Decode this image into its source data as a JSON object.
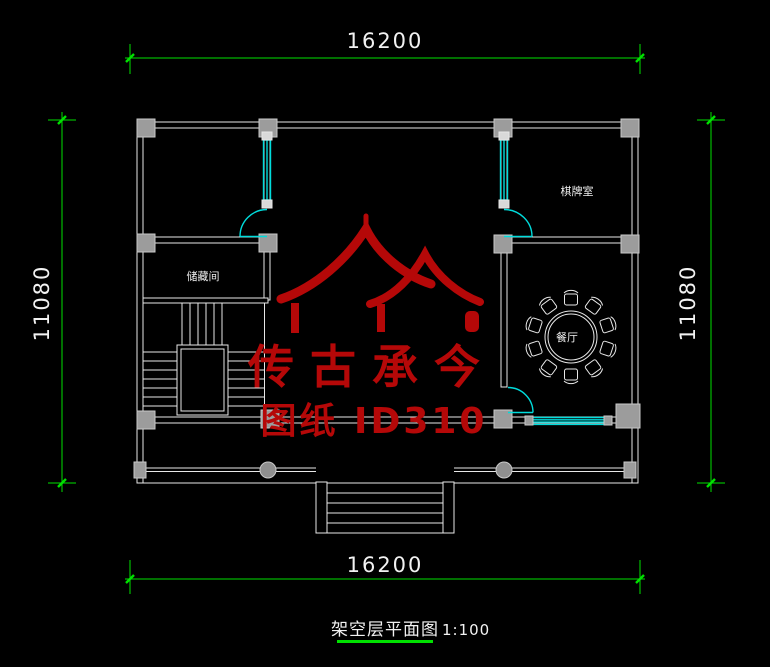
{
  "plan": {
    "dim_top": "16200",
    "dim_bottom": "16200",
    "dim_left": "11080",
    "dim_right": "11080",
    "rooms": {
      "chess": "棋牌室",
      "storage": "储藏间",
      "dining": "餐厅"
    },
    "watermark": {
      "brand": "传古承今",
      "sheet_id": "图纸 ID310"
    },
    "title": "架空层平面图",
    "scale": "1:100",
    "colors": {
      "background": "#000000",
      "wall_line": "#e8e8e8",
      "column_fill": "#9c9c9c",
      "fixture_cyan": "#00dcdc",
      "dimension_green": "#00e000",
      "text_white": "#f2f2f2",
      "watermark_red": "#b50808"
    }
  }
}
